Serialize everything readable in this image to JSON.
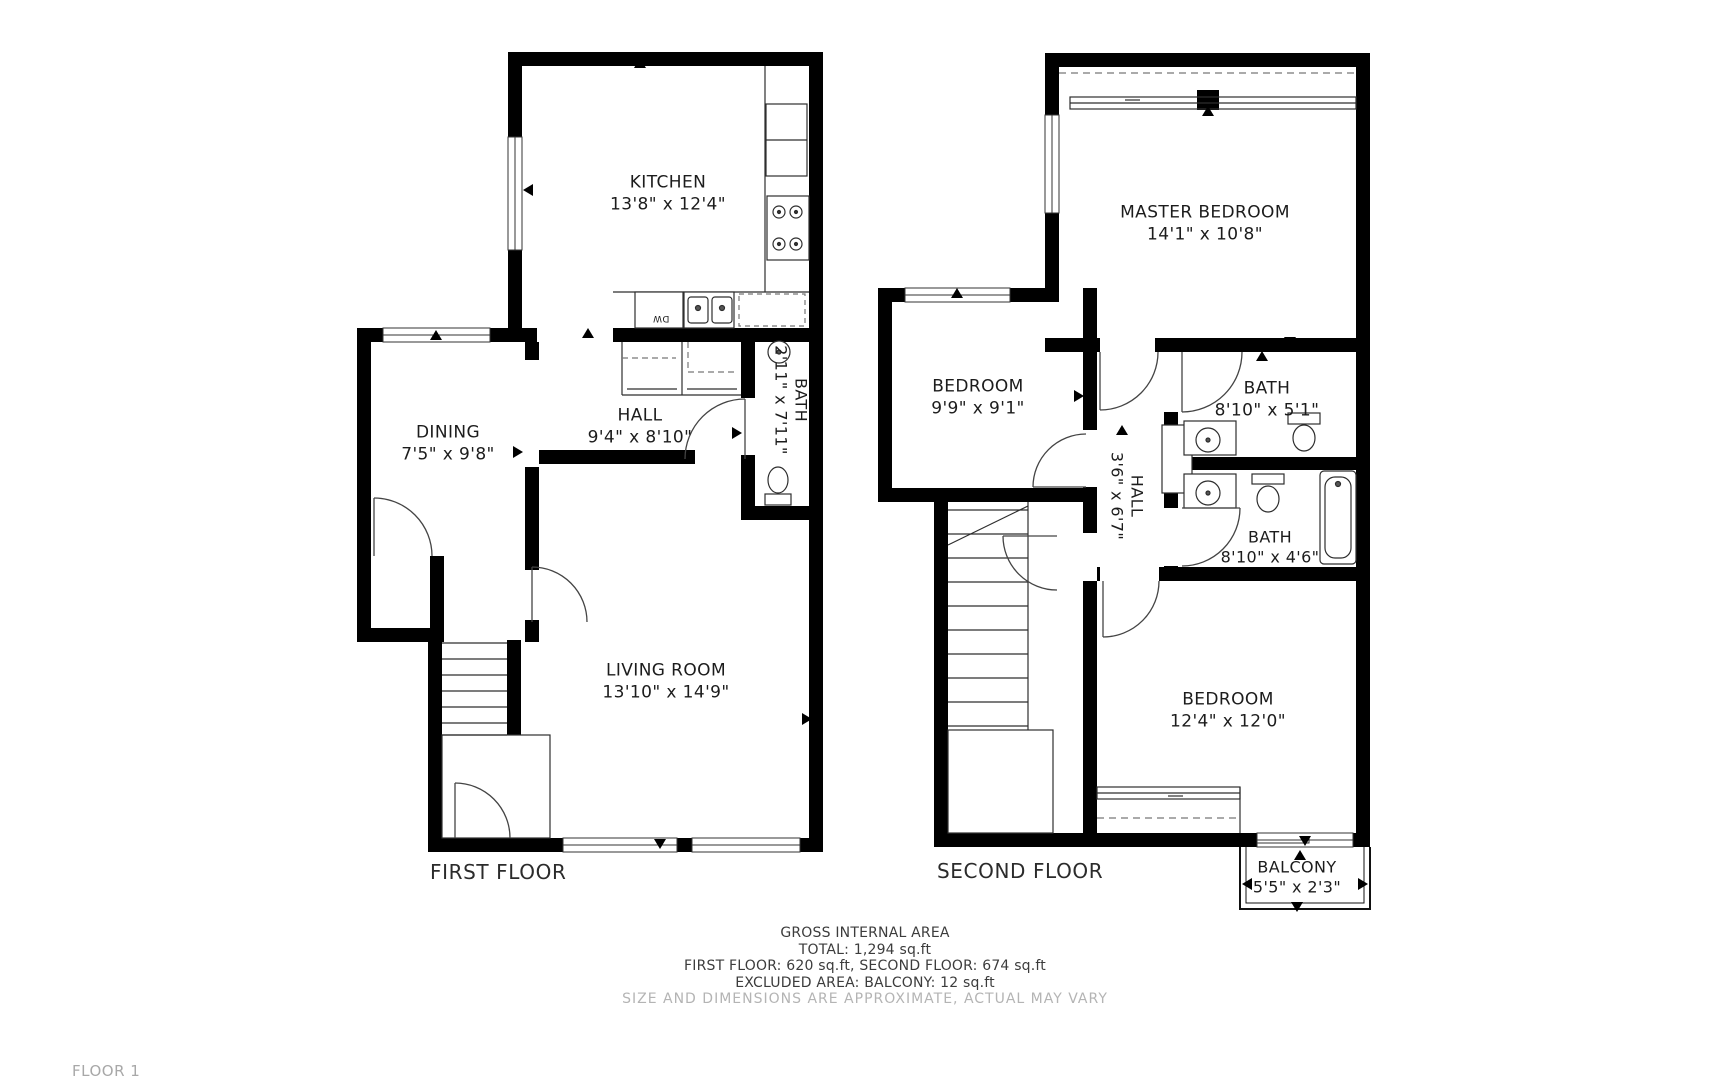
{
  "document": {
    "floor_tag": "FLOOR 1"
  },
  "floors": [
    {
      "caption": "FIRST FLOOR",
      "rooms": [
        {
          "name": "KITCHEN",
          "dims": "13'8\" x 12'4\""
        },
        {
          "name": "DINING",
          "dims": "7'5\" x 9'8\""
        },
        {
          "name": "HALL",
          "dims": "9'4\" x 8'10\""
        },
        {
          "name": "BATH",
          "dims": "2'11\" x 7'11\""
        },
        {
          "name": "LIVING ROOM",
          "dims": "13'10\" x 14'9\""
        }
      ],
      "appliances": {
        "dishwasher": "DW"
      }
    },
    {
      "caption": "SECOND FLOOR",
      "rooms": [
        {
          "name": "MASTER BEDROOM",
          "dims": "14'1\" x 10'8\""
        },
        {
          "name": "BEDROOM",
          "dims": "9'9\" x 9'1\""
        },
        {
          "name": "BATH",
          "dims": "8'10\" x 5'1\""
        },
        {
          "name": "HALL",
          "dims": "3'6\" x 6'7\""
        },
        {
          "name": "BATH",
          "dims": "8'10\" x 4'6\""
        },
        {
          "name": "BEDROOM",
          "dims": "12'4\" x 12'0\""
        },
        {
          "name": "BALCONY",
          "dims": "5'5\" x 2'3\""
        }
      ]
    }
  ],
  "summary": {
    "title": "GROSS INTERNAL AREA",
    "total": "TOTAL: 1,294 sq.ft",
    "per_floor": "FIRST FLOOR: 620 sq.ft, SECOND FLOOR: 674 sq.ft",
    "excluded": "EXCLUDED AREA: BALCONY: 12 sq.ft",
    "disclaimer": "SIZE AND DIMENSIONS ARE APPROXIMATE, ACTUAL MAY VARY"
  },
  "colors": {
    "walls": "#000000",
    "background": "#ffffff",
    "label_text": "#1c1c1c",
    "summary_text": "#3c3c3c",
    "muted_text": "#b4b4b4"
  }
}
